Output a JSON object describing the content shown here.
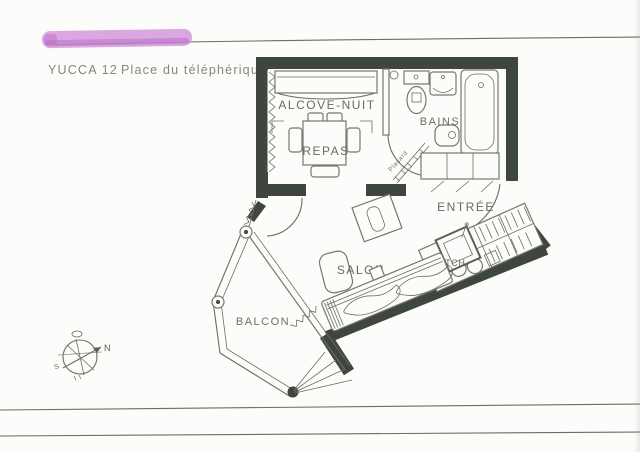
{
  "page": {
    "title_left": "YUCCA 12",
    "title_right": "Place du téléphérique"
  },
  "plan": {
    "rooms": {
      "alcove": "ALCOVE-NUIT",
      "bains": "BAINS",
      "repas": "REPAS",
      "entree": "ENTRÉE",
      "salon": "SALON",
      "balcon": "BALCON",
      "kitchenette": "KITCH.",
      "placard": "Placard"
    },
    "compass": {
      "north": "N",
      "south": "S"
    }
  },
  "colors": {
    "paper": "#fcfcfa",
    "wall_ink": "#3f453f",
    "line_ink": "#6b6e64",
    "label_ink": "#5c5f55",
    "title_ink": "#8d8377",
    "highlighter": "#cf8ed8"
  }
}
